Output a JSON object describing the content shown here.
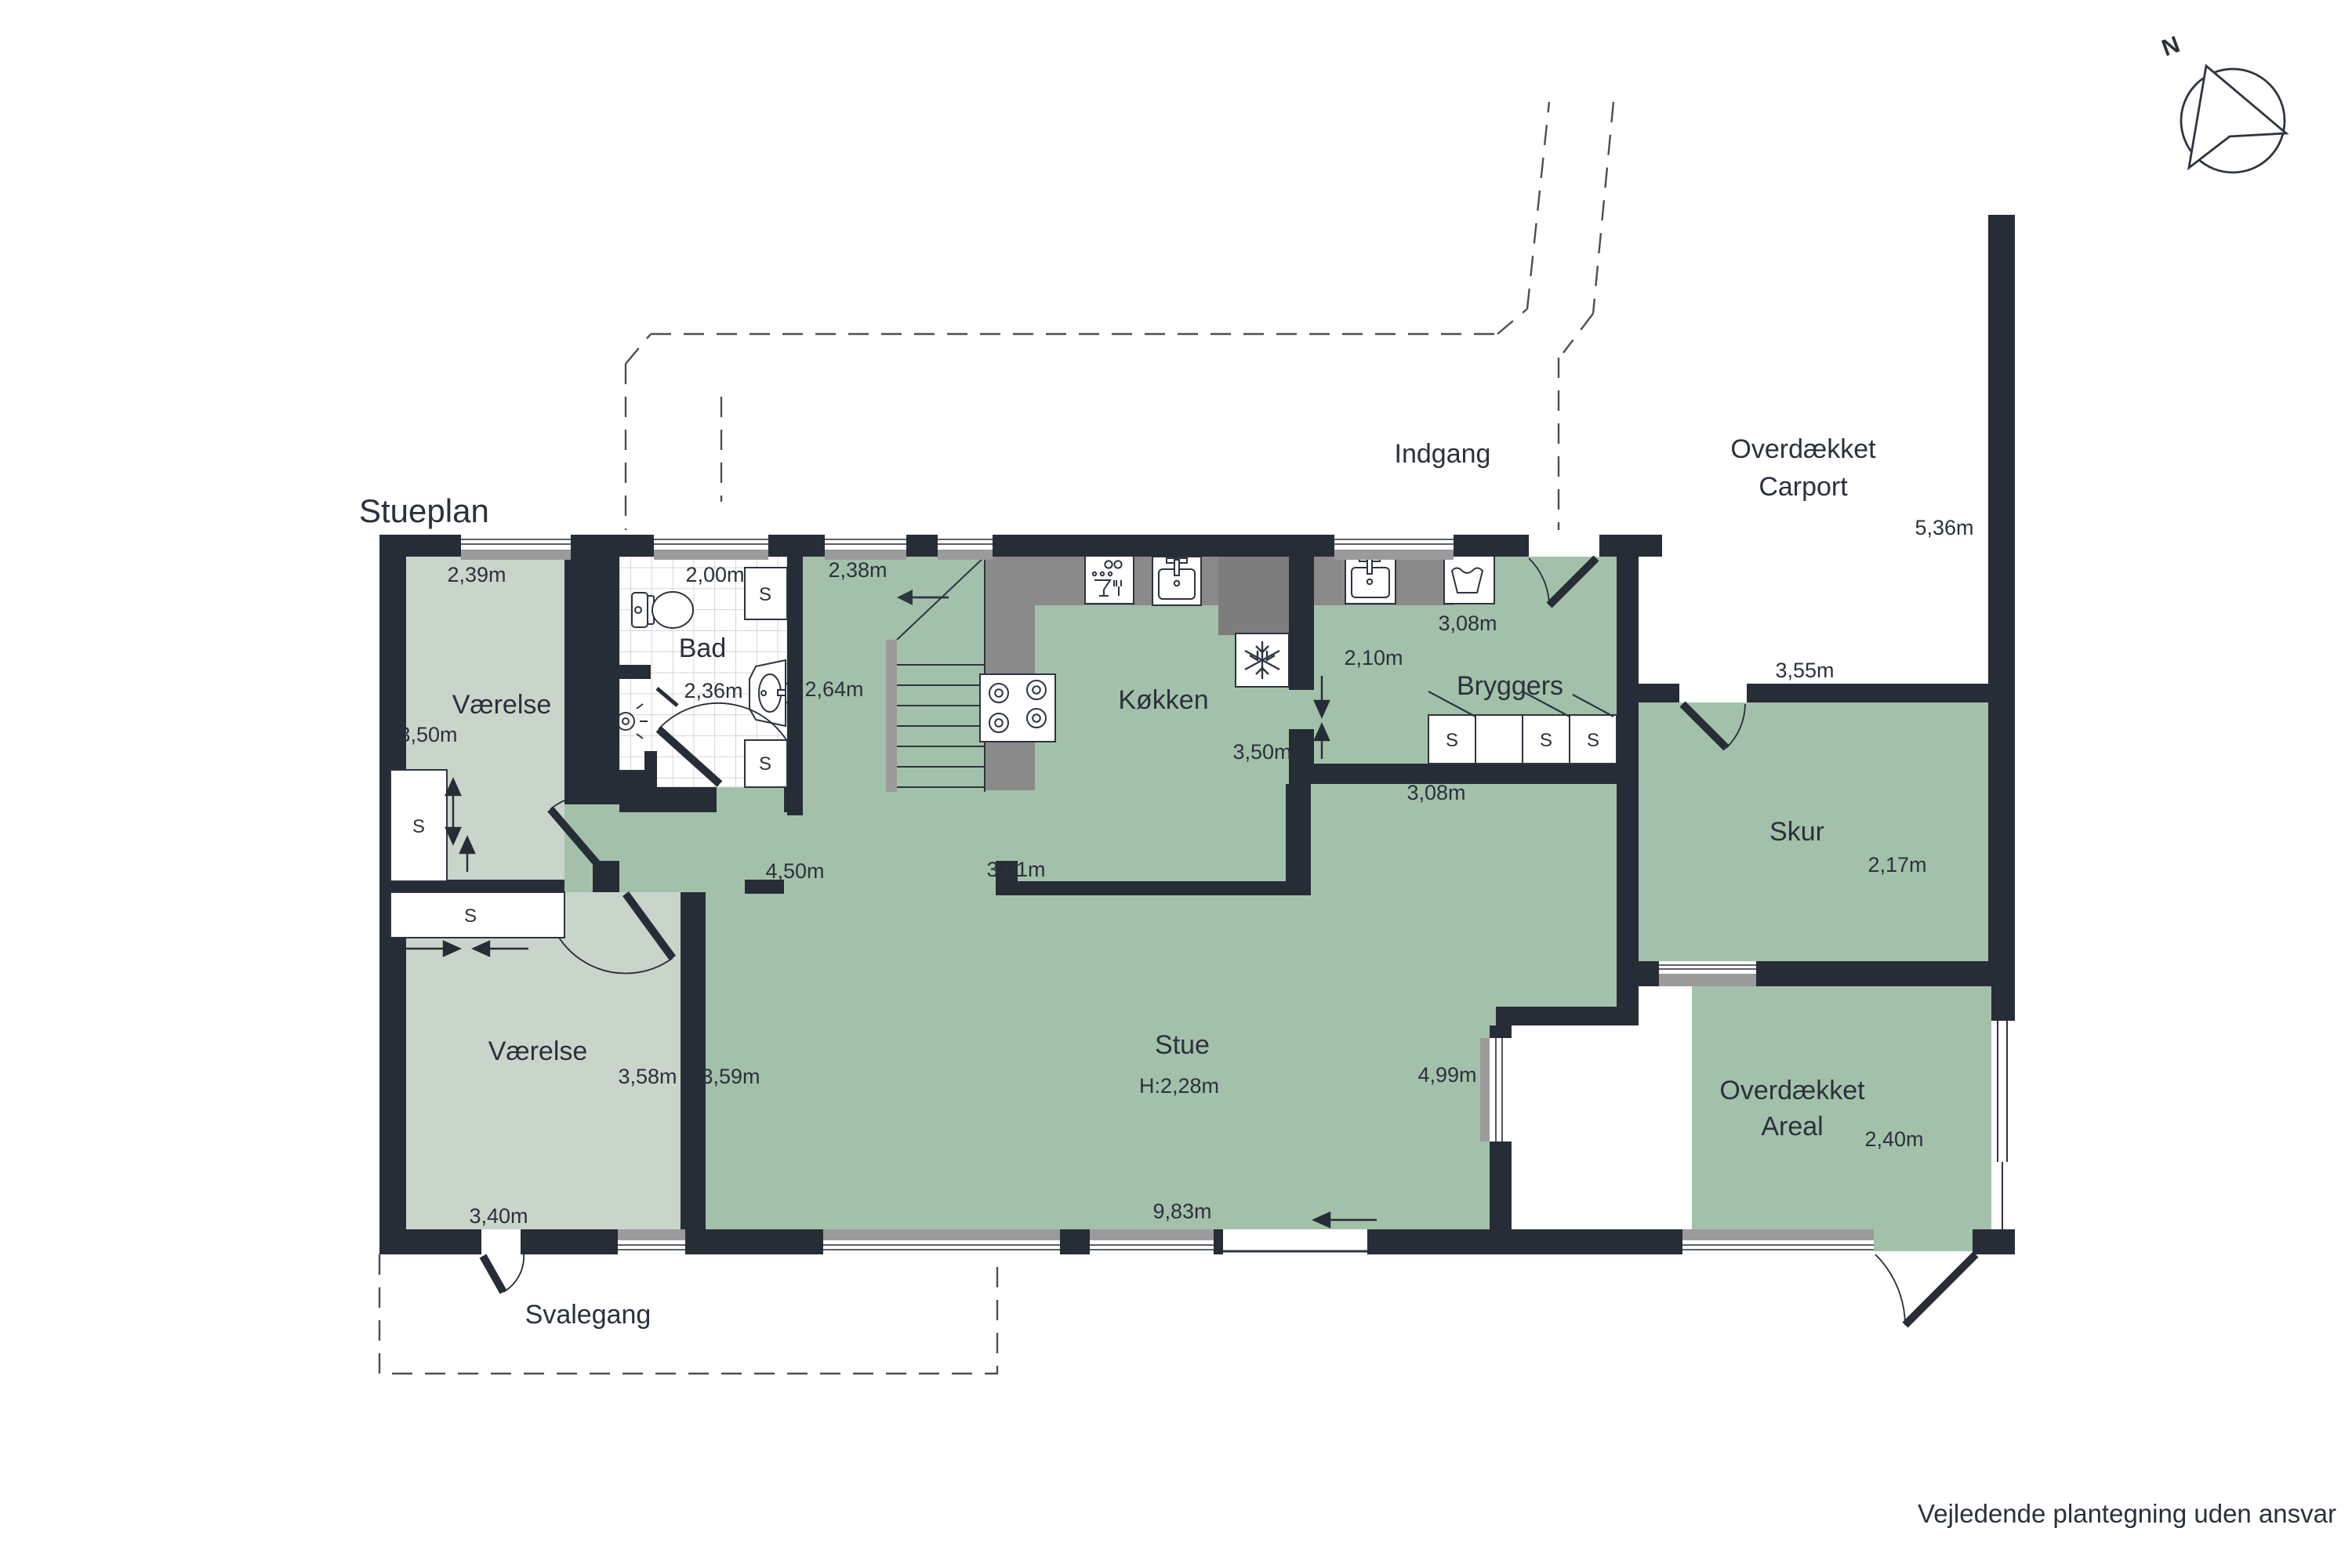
{
  "title": "Stueplan",
  "disclaimer": "Vejledende plantegning uden ansvar",
  "compass": {
    "north": "N"
  },
  "closets": {
    "s": "S"
  },
  "labels": {
    "vaerelse1": {
      "name": "Værelse",
      "width": "2,39m",
      "depth": "3,50m"
    },
    "vaerelse2": {
      "name": "Værelse",
      "width_left": "3,58m",
      "width_right": "3,59m",
      "width_bottom": "3,40m"
    },
    "bad": {
      "name": "Bad",
      "width": "2,00m",
      "depth": "2,36m"
    },
    "hall": {
      "width": "2,38m",
      "depth": "2,64m",
      "gang": "4,50m",
      "stub": "3,01m"
    },
    "koekken": {
      "name": "Køkken",
      "depth": "3,50m"
    },
    "bryggers": {
      "name": "Bryggers",
      "width_top": "3,08m",
      "width_bottom": "3,08m",
      "depth": "2,10m"
    },
    "stue": {
      "name": "Stue",
      "ceiling_height": "H:2,28m",
      "depth": "4,99m",
      "width": "9,83m"
    },
    "skur": {
      "name": "Skur",
      "width": "3,55m",
      "depth": "2,17m"
    },
    "overdaekket_areal": {
      "line1": "Overdækket",
      "line2": "Areal",
      "width": "2,40m"
    },
    "carport": {
      "line1": "Overdækket",
      "line2": "Carport",
      "depth": "5,36m"
    },
    "indgang": "Indgang",
    "svalegang": "Svalegang"
  },
  "colors": {
    "wall": "#272d36",
    "room_green": "#a3c1aa",
    "room_light": "#c9d5ca",
    "counter_gray": "#8a8a8a",
    "cabinet_gray": "#7d7d7d",
    "sill_gray": "#9b9b9b",
    "background": "#ffffff"
  }
}
